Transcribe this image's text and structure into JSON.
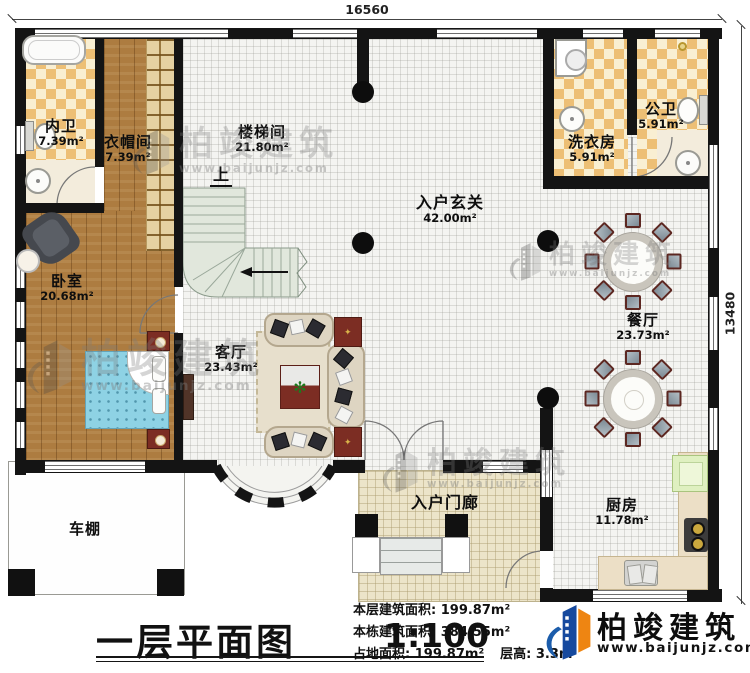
{
  "plan": {
    "dim_top": "16560",
    "dim_right": "13480",
    "stair_up": "上",
    "rooms": {
      "neiwei": {
        "name": "内卫",
        "area": "7.39m²"
      },
      "yimaojian": {
        "name": "衣帽间",
        "area": "7.39m²"
      },
      "loutijian": {
        "name": "楼梯间",
        "area": "21.80m²"
      },
      "xiyifang": {
        "name": "洗衣房",
        "area": "5.91m²"
      },
      "gongwei": {
        "name": "公卫",
        "area": "5.91m²"
      },
      "ruhuxuanguan": {
        "name": "入户玄关",
        "area": "42.00m²"
      },
      "woshi": {
        "name": "卧室",
        "area": "20.68m²"
      },
      "keting": {
        "name": "客厅",
        "area": "23.43m²"
      },
      "canting": {
        "name": "餐厅",
        "area": "23.73m²"
      },
      "chufang": {
        "name": "厨房",
        "area": "11.78m²"
      },
      "ruhumenlang": {
        "name": "入户门廊"
      },
      "chepeng": {
        "name": "车棚"
      }
    }
  },
  "footer": {
    "title": "一层平面图",
    "scale": "1:100",
    "stats": {
      "line1_label": "本层建筑面积: ",
      "line1_value": "199.87m²",
      "line2_label": "本栋建筑面积: ",
      "line2_value": "384.55m²",
      "line3a_label": "占地面积: ",
      "line3a_value": "199.87m²",
      "line3b_label": "层高: ",
      "line3b_value": "3.3m"
    },
    "brand": {
      "name": "柏竣建筑",
      "url": "www.baijunjz.com"
    }
  },
  "watermark": {
    "name": "柏竣建筑",
    "url": "www.baijunjz.com"
  }
}
